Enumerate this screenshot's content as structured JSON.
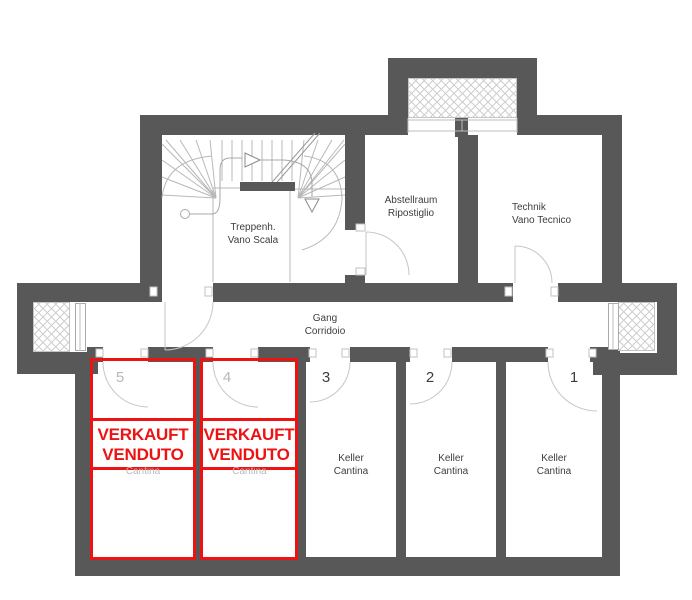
{
  "plan": {
    "colors": {
      "wall": "#585858",
      "accent_red": "#ee1313",
      "line": "#c6c6c6",
      "text": "#3d3d3d",
      "muted": "#b8b8b8"
    },
    "labels": {
      "stairwell": {
        "line1": "Treppenh.",
        "line2": "Vano Scala"
      },
      "storage": {
        "line1": "Abstellraum",
        "line2": "Ripostiglio"
      },
      "technical": {
        "line1": "Technik",
        "line2": "Vano Tecnico"
      },
      "corridor": {
        "line1": "Gang",
        "line2": "Corridoio"
      }
    },
    "cellar_rooms": [
      {
        "number": "5",
        "sold": true,
        "partial_label": "Cantina"
      },
      {
        "number": "4",
        "sold": true,
        "partial_label": "Cantina"
      },
      {
        "number": "3",
        "label_line1": "Keller",
        "label_line2": "Cantina"
      },
      {
        "number": "2",
        "label_line1": "Keller",
        "label_line2": "Cantina"
      },
      {
        "number": "1",
        "label_line1": "Keller",
        "label_line2": "Cantina"
      }
    ],
    "sold_overlay": {
      "line1": "VERKAUFT",
      "line2": "VENDUTO"
    }
  }
}
